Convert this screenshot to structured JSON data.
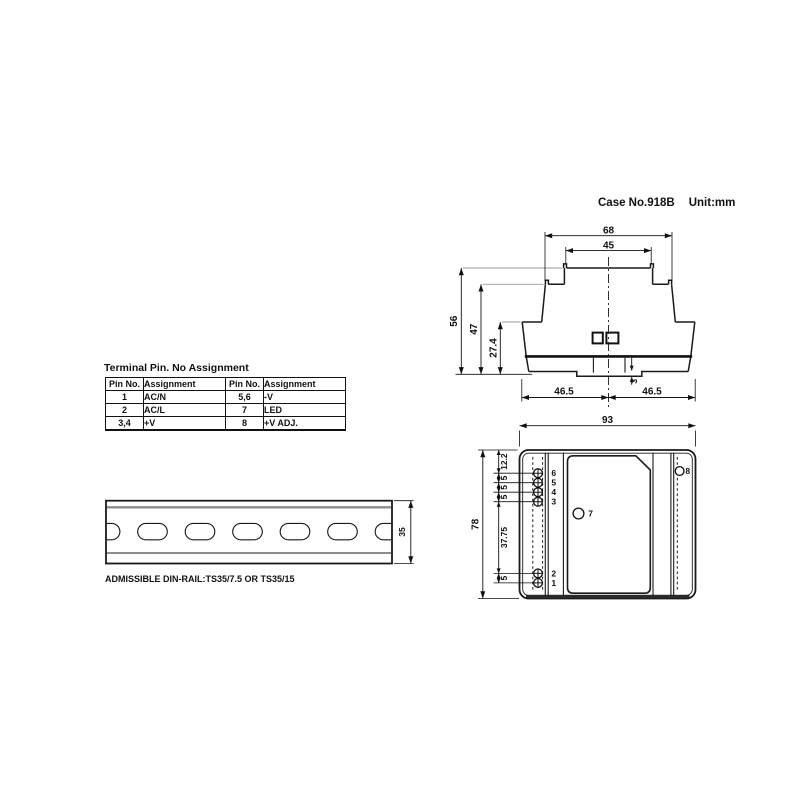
{
  "header": {
    "case_no": "Case No.918B",
    "unit": "Unit:mm"
  },
  "front_view": {
    "dims": {
      "top_width": "68",
      "inner_top_width": "45",
      "height_total": "56",
      "height_mid": "47",
      "height_low": "27.4",
      "clip_depth": "3",
      "base_left": "46.5",
      "base_right": "46.5"
    }
  },
  "pin_table": {
    "title": "Terminal Pin. No Assignment",
    "headers": [
      "Pin No.",
      "Assignment",
      "Pin No.",
      "Assignment"
    ],
    "rows": [
      [
        "1",
        "AC/N",
        "5,6",
        "-V"
      ],
      [
        "2",
        "AC/L",
        "7",
        "LED"
      ],
      [
        "3,4",
        "+V",
        "8",
        "+V ADJ."
      ]
    ]
  },
  "din_rail": {
    "dim_height": "35",
    "caption": "ADMISSIBLE DIN-RAIL:TS35/7.5 OR TS35/15"
  },
  "rear_view": {
    "dims": {
      "width": "93",
      "height": "78"
    },
    "chain": [
      "12.2",
      "5",
      "5",
      "5",
      "37.75",
      "5"
    ],
    "pins": [
      "6",
      "5",
      "4",
      "3",
      "2",
      "1"
    ],
    "led_label": "7",
    "adj_label": "8"
  }
}
